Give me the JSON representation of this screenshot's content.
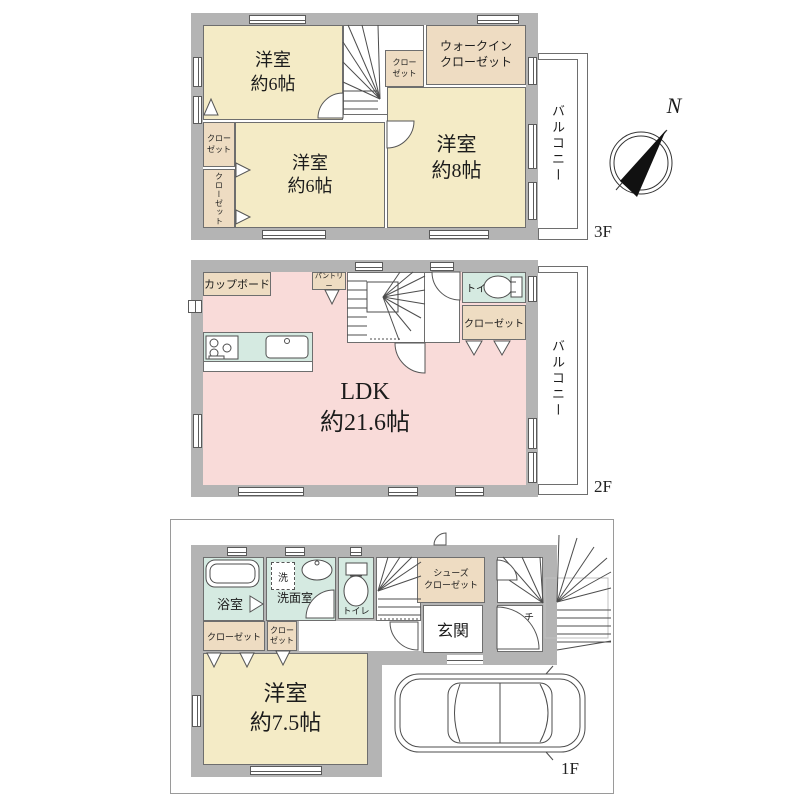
{
  "compass": {
    "north": "N"
  },
  "colors": {
    "wall_gray": "#b4b4b4",
    "room_cream": "#f4ebc6",
    "closet_beige": "#eedcc2",
    "ldk_pink": "#f9dbd9",
    "wet_teal": "#d5eae1",
    "line": "#4d4d4d"
  },
  "floor3": {
    "label": "3F",
    "balcony": "バルコニー",
    "room_nw": "洋室\n約6帖",
    "room_sw": "洋室\n約6帖",
    "room_e": "洋室\n約8帖",
    "walkin_closet": "ウォークイン\nクローゼット",
    "closet_stair": "クロー\nゼット",
    "closet_w1": "クロー\nゼット",
    "closet_w2": "クローゼット"
  },
  "floor2": {
    "label": "2F",
    "balcony": "バルコニー",
    "ldk": "LDK\n約21.6帖",
    "cupboard": "カップボード",
    "pantry": "パントリー",
    "toilet": "トイレ",
    "closet": "クローゼット"
  },
  "floor1": {
    "label": "1F",
    "bath": "浴室",
    "laundry": "洗",
    "washroom": "洗面室",
    "toilet": "トイレ",
    "shoe_closet": "シューズ\nクローゼット",
    "entrance": "玄関",
    "porch": "ポーチ",
    "closet_a": "クローゼット",
    "closet_b": "クロー\nゼット",
    "room": "洋室\n約7.5帖"
  }
}
